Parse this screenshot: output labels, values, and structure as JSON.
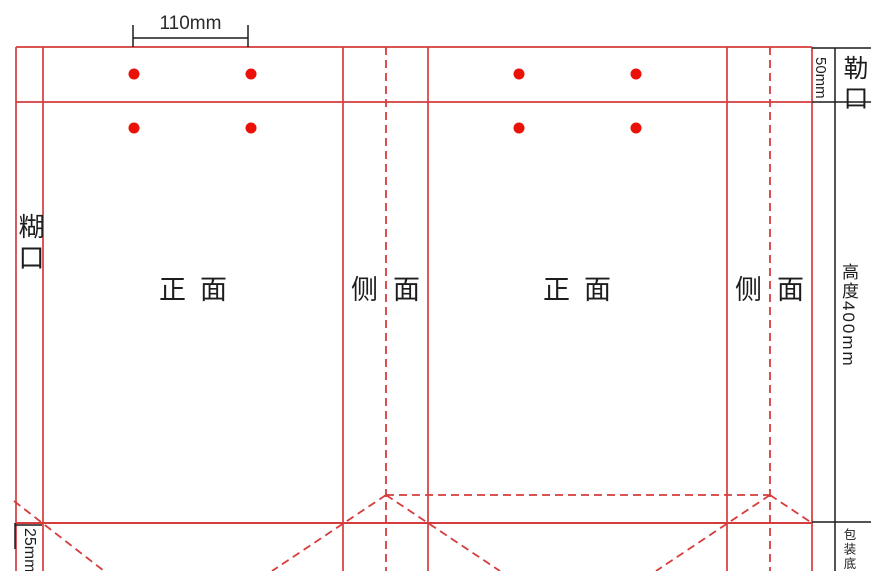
{
  "drawing_type": "paper-bag dieline template",
  "colors": {
    "line": "#d63c3c",
    "dot": "#ea1208",
    "dim": "#1c1c1c"
  },
  "panels": {
    "glue_flap": "糊口",
    "front": "正面",
    "side": "侧面",
    "top_fold": "勒口"
  },
  "dims": {
    "hole_spacing": "110mm",
    "top_fold_height": "50mm",
    "bag_height": "高度400mm",
    "bottom_margin": "25mm",
    "bottom_note": "包装底65"
  }
}
